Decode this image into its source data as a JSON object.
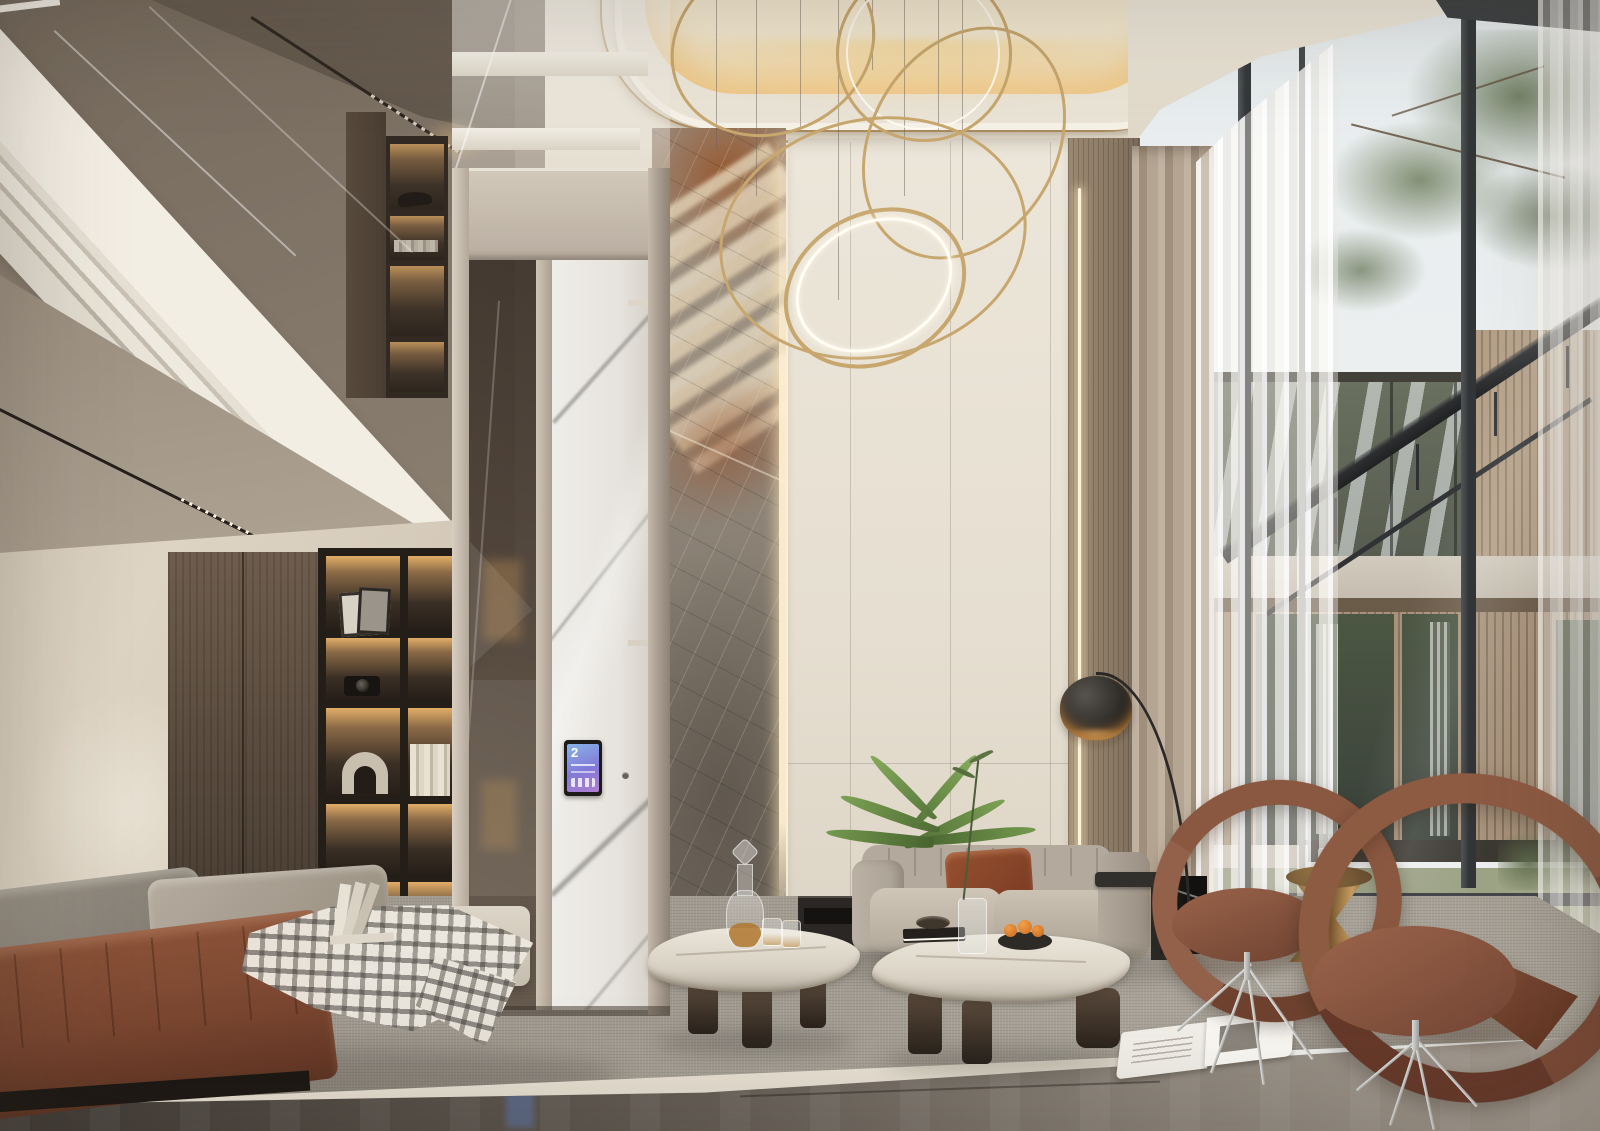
{
  "meta": {
    "type": "photorealistic interior render",
    "room": "double-height modern luxury living room with mezzanine, home elevator and floor-to-ceiling glazing"
  },
  "palette": {
    "ceiling_cream": "#efeade",
    "cove_warm": "#f2dcae",
    "gold": "#b08d57",
    "gold2": "#c7a76e",
    "wall_cream": "#e9e2d4",
    "wall_taupe": "#8d8174",
    "upstairs_dark": "#6b6055",
    "wood_dark": "#54473c",
    "niche_glow": "#d8a964",
    "elevator_frame": "#c8beb0",
    "marble_gray": "#8d857b",
    "marble_rust": "#9a5c2f",
    "marble_cream": "#d6c9b2",
    "slat_wood": "#93816d",
    "curtain_greige": "#b3a492",
    "sheer_white": "#f3f1ed",
    "frame_dark": "#3a3d3f",
    "sky": "#e9edef",
    "pine_green": "#5f6f52",
    "house_wood": "#ab957d",
    "house_concrete": "#ccc5b8",
    "lawn": "#8f9678",
    "rug": "#a6a095",
    "floor_dark": "#4f4943",
    "leather_brown": "#7d4b33",
    "sofa_gray": "#b7aea1",
    "pillow_rust": "#8e4a2e",
    "chair_brown": "#8a573d",
    "table_marble": "#e2dcd0",
    "bronze": "#a87f4e",
    "screen_blue": "#5b7fd8"
  },
  "elevator": {
    "screen": {
      "floor_label": "2"
    }
  },
  "scene": {
    "elements": [
      {
        "name": "ring-chandelier",
        "description": "cluster of five gold LED hoop pendants on thin cables"
      },
      {
        "name": "coffered-ceiling",
        "description": "rounded recessed ceiling tray with warm cove light and gold trim"
      },
      {
        "name": "mezzanine",
        "description": "upper balcony with white fascia and smoked glass railing"
      },
      {
        "name": "backlit-shelving",
        "description": "dark wood niches with warm LED wash, frames, camera, arch sculpture and books"
      },
      {
        "name": "glass-elevator",
        "description": "beige framed home lift with white marble cab and touchscreen showing floor 2"
      },
      {
        "name": "marble-feature-wall",
        "description": "grey-rust veined stone slab wall with edge LED strip"
      },
      {
        "name": "panel-wall",
        "description": "cream lacquered panels with shadow gaps"
      },
      {
        "name": "slat-wall",
        "description": "taupe wood panel with vertical LED strip"
      },
      {
        "name": "curtain-wall-window",
        "description": "black mullioned double-height glazing"
      },
      {
        "name": "exterior-view",
        "description": "pine branches, lawn and a timber-clad neighbouring house"
      },
      {
        "name": "sheer-curtains",
        "description": "white voile panels with greige blackout drape"
      },
      {
        "name": "arc-floor-lamp",
        "description": "black dome arc lamp on black marble block"
      },
      {
        "name": "gray-sofa",
        "description": "channel-tufted greige fabric sofa with rust velvet cushion"
      },
      {
        "name": "indoor-plant",
        "description": "areca palm fronds behind sofa"
      },
      {
        "name": "marble-coffee-tables",
        "description": "two organic-shaped stone tables on dark oak feet"
      },
      {
        "name": "decanter-set",
        "description": "crystal whiskey decanter with two glasses"
      },
      {
        "name": "fruit-bowl",
        "description": "dark bowl with oranges"
      },
      {
        "name": "leather-daybed",
        "description": "cognac leather bench with taupe pillows and gingham throw"
      },
      {
        "name": "swivel-lounge-chairs",
        "description": "two cognac leather hoop chairs on polished star bases"
      },
      {
        "name": "bronze-side-table",
        "description": "twisted bronze hourglass drum table"
      },
      {
        "name": "open-magazine",
        "description": "magazine lying open on the rug"
      },
      {
        "name": "area-rug",
        "description": "large mottled grey wool rug"
      },
      {
        "name": "stone-floor",
        "description": "polished dark marble floor strip with reflections"
      }
    ]
  }
}
